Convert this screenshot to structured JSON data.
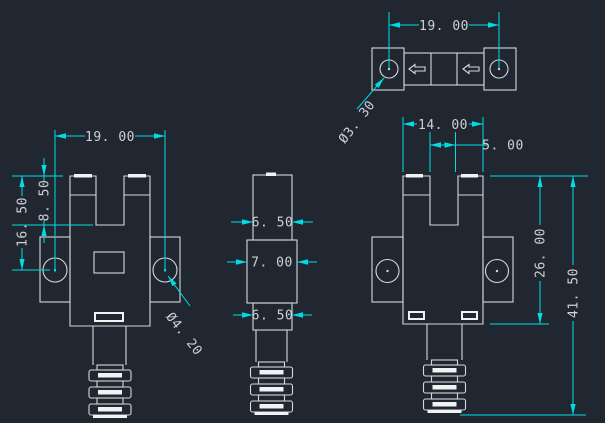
{
  "drawing": {
    "kind": "CAD technical drawing of a slot-type optical sensor, 4 orthographic views",
    "views": {
      "top": {
        "label": "top-view",
        "dims": {
          "hole_span": "19. 00",
          "hole_diameter": "Ø3. 30"
        }
      },
      "front": {
        "label": "front-view",
        "dims": {
          "hole_span": "19. 00",
          "top_to_hole_center": "16. 50",
          "slot_depth": "8. 50",
          "hole_diameter": "Ø4. 20"
        }
      },
      "side": {
        "label": "side-view",
        "dims": {
          "upper_width": "6. 50",
          "middle_width": "7. 00",
          "lower_width": "6. 50"
        }
      },
      "back": {
        "label": "back-view",
        "dims": {
          "body_width": "14. 00",
          "slot_width": "5. 00",
          "body_height": "26. 00",
          "overall_height": "41. 50"
        }
      }
    }
  },
  "colors": {
    "background": "#212731",
    "geometry_line": "#d4d8db",
    "highlight_line": "#f0f2f4",
    "dimension_line": "#00dce4",
    "dimension_text": "#cdd1d5"
  }
}
